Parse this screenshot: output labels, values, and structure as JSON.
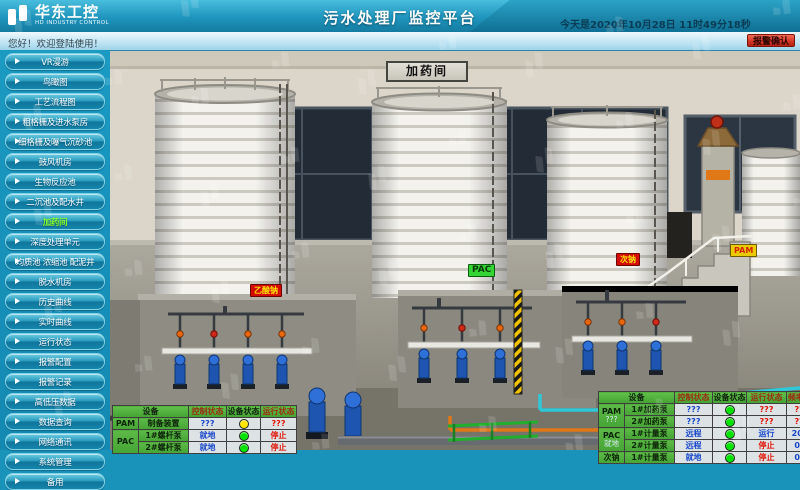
{
  "colors": {
    "header_teal": "#1f95bd",
    "sidebar_teal": "#1489b2",
    "active_item_green": "#86ff2a",
    "alarm_button_red": "#d03524",
    "status_stop_red": "#e01405",
    "status_run_blue": "#1747c9",
    "indicator_green": "#00e400",
    "indicator_yellow": "#ffe600",
    "table_header_green": "#4fb23c"
  },
  "header": {
    "logo_title": "华东工控",
    "logo_subtitle": "HD INDUSTRY CONTROL",
    "title": "污水处理厂监控平台",
    "datetime": "今天是2020年10月28日 11时49分18秒"
  },
  "welcome": {
    "greeting": "您好！欢迎登陆使用！",
    "alarm_button": "报警确认"
  },
  "sidebar": {
    "items": [
      {
        "label": "VR漫游",
        "state": "normal"
      },
      {
        "label": "鸟瞰图",
        "state": "normal"
      },
      {
        "label": "工艺流程图",
        "state": "normal"
      },
      {
        "label": "粗格栅及进水泵房",
        "state": "normal"
      },
      {
        "label": "细格栅及曝气沉砂池",
        "state": "normal"
      },
      {
        "label": "鼓风机房",
        "state": "normal"
      },
      {
        "label": "生物反应池",
        "state": "normal"
      },
      {
        "label": "二沉池及配水井",
        "state": "normal"
      },
      {
        "label": "加药间",
        "state": "active"
      },
      {
        "label": "深度处理单元",
        "state": "normal"
      },
      {
        "label": "均质池 浓缩池 配泥井",
        "state": "normal"
      },
      {
        "label": "脱水机房",
        "state": "normal"
      },
      {
        "label": "历史曲线",
        "state": "normal"
      },
      {
        "label": "实时曲线",
        "state": "normal"
      },
      {
        "label": "运行状态",
        "state": "normal"
      },
      {
        "label": "报警配置",
        "state": "normal"
      },
      {
        "label": "报警记录",
        "state": "normal"
      },
      {
        "label": "高低压数据",
        "state": "normal"
      },
      {
        "label": "数据查询",
        "state": "normal"
      },
      {
        "label": "网络通讯",
        "state": "normal"
      },
      {
        "label": "系统管理",
        "state": "normal"
      },
      {
        "label": "备用",
        "state": "normal"
      }
    ]
  },
  "scene": {
    "room_title": "加药间",
    "labels": [
      {
        "text": "乙酸钠",
        "style": "lbl-red"
      },
      {
        "text": "PAC",
        "style": "lbl-green"
      },
      {
        "text": "次钠",
        "style": "lbl-red"
      },
      {
        "text": "PAM",
        "style": "lbl-yellow"
      }
    ]
  },
  "left_table": {
    "headers": [
      {
        "label": "设备",
        "color": "hdr-dark"
      },
      {
        "label": "控制状态",
        "color": "hdr-red"
      },
      {
        "label": "设备状态",
        "color": "hdr-dark"
      },
      {
        "label": "运行状态",
        "color": "hdr-red"
      }
    ],
    "groups": [
      {
        "name": "PAM"
      },
      {
        "name": "PAC"
      }
    ],
    "rows": [
      {
        "name": "制备装置",
        "control": "???",
        "control_color": "c-blue",
        "dot": "dot-yellow",
        "run": "???",
        "run_color": "c-red"
      },
      {
        "name": "1#螺杆泵",
        "control": "就地",
        "control_color": "c-blue",
        "dot": "dot-green",
        "run": "停止",
        "run_color": "c-red"
      },
      {
        "name": "2#螺杆泵",
        "control": "就地",
        "control_color": "c-blue",
        "dot": "dot-green",
        "run": "停止",
        "run_color": "c-red"
      }
    ]
  },
  "right_table": {
    "headers": [
      {
        "label": "设备",
        "color": "hdr-dark"
      },
      {
        "label": "控制状态",
        "color": "hdr-red"
      },
      {
        "label": "设备状态",
        "color": "hdr-dark"
      },
      {
        "label": "运行状态",
        "color": "hdr-red"
      },
      {
        "label": "频率Hz",
        "color": "hdr-red"
      },
      {
        "label": "设",
        "color": "hdr-dark"
      }
    ],
    "groups": [
      {
        "name": "PAM",
        "status": "???"
      },
      {
        "name": "PAC",
        "status": "就地"
      },
      {
        "name": "次钠",
        "status": ""
      }
    ],
    "rows": [
      {
        "name": "1#加药泵",
        "control": "???",
        "control_color": "c-blue",
        "dot": "dot-green",
        "run": "???",
        "run_color": "c-red",
        "freq": "???",
        "freq_color": "c-red"
      },
      {
        "name": "2#加药泵",
        "control": "???",
        "control_color": "c-blue",
        "dot": "dot-green",
        "run": "???",
        "run_color": "c-red",
        "freq": "???",
        "freq_color": "c-red"
      },
      {
        "name": "1#计量泵",
        "control": "远程",
        "control_color": "c-blue",
        "dot": "dot-green",
        "run": "运行",
        "run_color": "c-blue",
        "freq": "20.8",
        "freq_color": "c-blue"
      },
      {
        "name": "2#计量泵",
        "control": "远程",
        "control_color": "c-blue",
        "dot": "dot-green",
        "run": "停止",
        "run_color": "c-red",
        "freq": "0.0",
        "freq_color": "c-blue"
      },
      {
        "name": "1#计量泵",
        "control": "就地",
        "control_color": "c-blue",
        "dot": "dot-green",
        "run": "停止",
        "run_color": "c-red",
        "freq": "0.0",
        "freq_color": "c-blue"
      }
    ]
  }
}
